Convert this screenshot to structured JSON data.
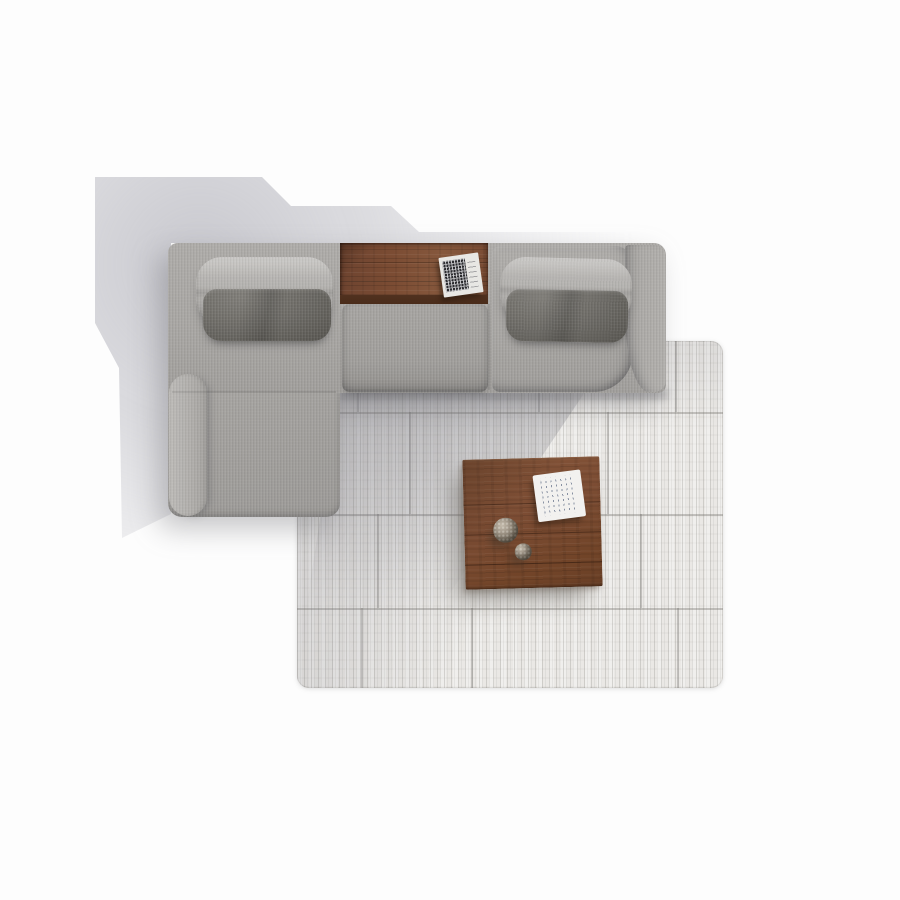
{
  "scene": {
    "description": "Top-down render of a living room set on a white floor",
    "objects": [
      {
        "name": "sectional-sofa",
        "label": "Gray fabric sectional sofa with left chaise"
      },
      {
        "name": "storage-tray",
        "label": "Built-in walnut wood tray shelf"
      },
      {
        "name": "tray-booklet",
        "label": "Small booklet with dense dark print lying on tray"
      },
      {
        "name": "area-rug",
        "label": "Light gray striated area rug with tile-block pattern"
      },
      {
        "name": "coffee-table",
        "label": "Square walnut coffee table"
      },
      {
        "name": "magazine",
        "label": "White booklet with illegible text lines on coffee table"
      },
      {
        "name": "decor-sphere-large",
        "label": "Large speckled decorative sphere"
      },
      {
        "name": "decor-sphere-small",
        "label": "Small speckled decorative sphere"
      }
    ]
  },
  "colors": {
    "floor": "#fdfdfd",
    "sofa-base": "#a8a6a3",
    "pillow-light": "#b7b5b2",
    "pillow-dark": "#64625d",
    "cushion-mid": "#a09e9b",
    "wood-base": "#7b4c33",
    "wood-dark": "#4a2c1a",
    "rug-base": "#eae8e5",
    "rug-seam": "#7d7a75",
    "paper": "#f2f1ef",
    "print-dark": "#2c2c30",
    "magazine-text": "#7e8aa0",
    "sphere-base": "#8f8578"
  }
}
